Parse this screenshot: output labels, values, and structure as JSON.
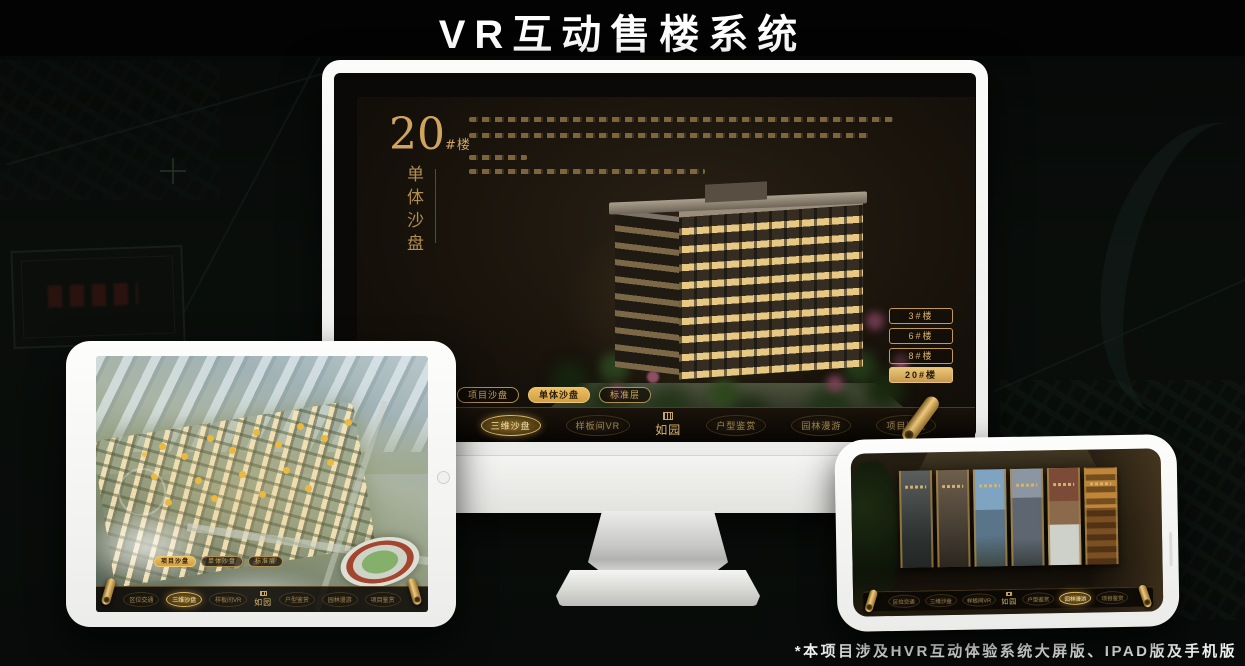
{
  "page": {
    "title": "VR互动售楼系统",
    "footnote": "*本项目涉及HVR互动体验系统大屏版、IPAD版及手机版"
  },
  "colors": {
    "gold": "#c9a05e",
    "gold_bright": "#eebe62",
    "screen_background": "#1a140c",
    "device_white": "#f5f5f3",
    "canvas_background": "#080b09"
  },
  "icons": {
    "scroll_handle": "rolled-gold-scroll",
    "brand_seal": "gold-seal-grid"
  },
  "desktop": {
    "hero": {
      "building_no": "20",
      "building_no_suffix": "#楼",
      "section_title": "单体沙盘"
    },
    "building_buttons": [
      {
        "label": "3#楼",
        "active": false
      },
      {
        "label": "6#楼",
        "active": false
      },
      {
        "label": "8#楼",
        "active": false
      },
      {
        "label": "20#楼",
        "active": true
      }
    ],
    "subtabs": [
      {
        "label": "项目沙盘",
        "active": false
      },
      {
        "label": "单体沙盘",
        "active": true
      },
      {
        "label": "标准层",
        "active": false
      }
    ],
    "nav": {
      "logo": "如园",
      "items": [
        {
          "label": "区位交通",
          "active": false
        },
        {
          "label": "三维沙盘",
          "active": true
        },
        {
          "label": "样板间VR",
          "active": false
        },
        {
          "label": "户型鉴赏",
          "active": false
        },
        {
          "label": "园林漫游",
          "active": false
        },
        {
          "label": "项目鉴赏",
          "active": false
        }
      ]
    }
  },
  "tablet": {
    "subtabs": [
      {
        "label": "项目沙盘",
        "active": true
      },
      {
        "label": "单体沙盘",
        "active": false
      },
      {
        "label": "标准层",
        "active": false
      }
    ],
    "nav": {
      "logo": "如园",
      "items": [
        {
          "label": "区位交通",
          "active": false
        },
        {
          "label": "三维沙盘",
          "active": true
        },
        {
          "label": "样板间VR",
          "active": false
        },
        {
          "label": "户型鉴赏",
          "active": false
        },
        {
          "label": "园林漫游",
          "active": false
        },
        {
          "label": "项目鉴赏",
          "active": false
        }
      ]
    }
  },
  "phone": {
    "nav": {
      "logo": "如园",
      "items": [
        {
          "label": "区位交通",
          "active": false
        },
        {
          "label": "三维沙盘",
          "active": false
        },
        {
          "label": "样板间VR",
          "active": false
        },
        {
          "label": "户型鉴赏",
          "active": false
        },
        {
          "label": "园林漫游",
          "active": true
        },
        {
          "label": "项目鉴赏",
          "active": false
        }
      ]
    }
  }
}
